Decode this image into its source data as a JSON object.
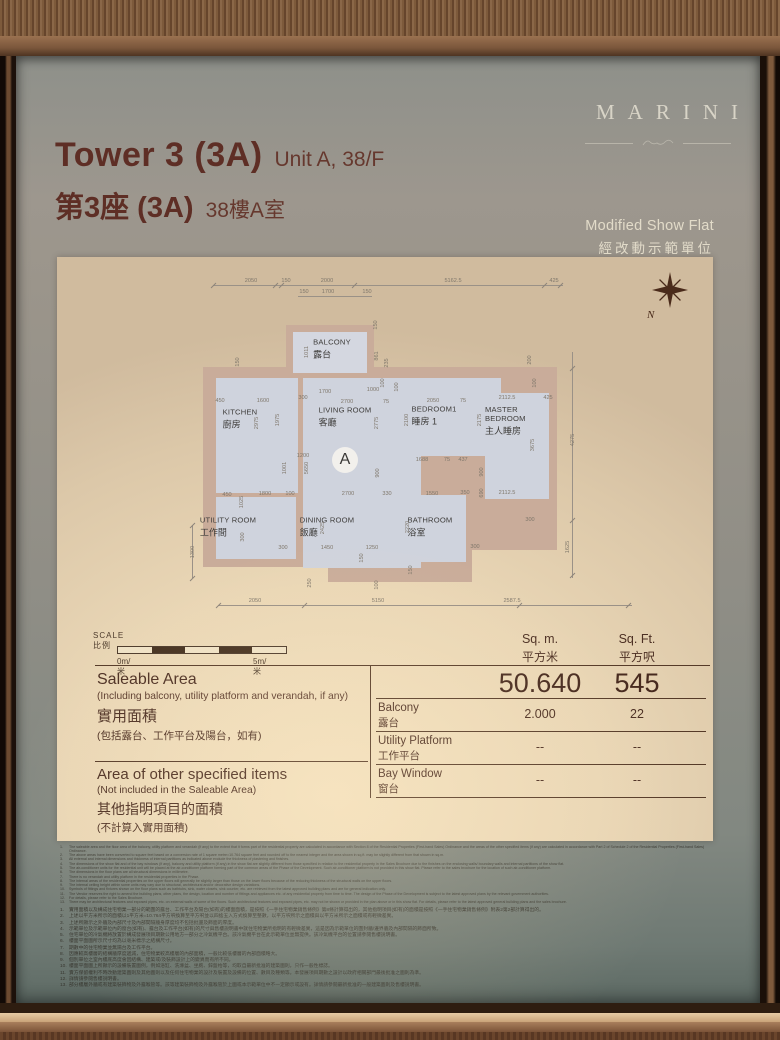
{
  "header": {
    "tower_en": "Tower 3 (3A)",
    "unit_en": "Unit A, 38/F",
    "tower_zh": "第3座 (3A)",
    "unit_zh": "38樓A室",
    "brand": "MARINI",
    "showflat_en": "Modified Show Flat",
    "showflat_zh": "經改動示範單位"
  },
  "floorplan": {
    "unit_marker": "A",
    "north_label": "N",
    "rooms": [
      {
        "en": "BALCONY",
        "zh": "露台",
        "x": 237,
        "y": 84
      },
      {
        "en": "KITCHEN",
        "zh": "廚房",
        "x": 145,
        "y": 154
      },
      {
        "en": "LIVING ROOM",
        "zh": "客廳",
        "x": 250,
        "y": 152
      },
      {
        "en": "BEDROOM1",
        "zh": "睡房 1",
        "x": 339,
        "y": 151
      },
      {
        "en": "MASTER BEDROOM",
        "zh": "主人睡房",
        "x": 418,
        "y": 156,
        "w": 56
      },
      {
        "en": "UTILITY ROOM",
        "zh": "工作間",
        "x": 133,
        "y": 262
      },
      {
        "en": "DINING ROOM",
        "zh": "飯廳",
        "x": 232,
        "y": 262
      },
      {
        "en": "BATHROOM",
        "zh": "浴室",
        "x": 335,
        "y": 262
      }
    ],
    "dims": [
      [
        "2050",
        156,
        16,
        0
      ],
      [
        "150",
        191,
        16,
        0
      ],
      [
        "2000",
        232,
        16,
        0
      ],
      [
        "5162.5",
        358,
        16,
        0
      ],
      [
        "425",
        459,
        16,
        0
      ],
      [
        "150",
        209,
        27,
        0
      ],
      [
        "1700",
        233,
        27,
        0
      ],
      [
        "150",
        272,
        27,
        0
      ],
      [
        "150",
        143,
        97,
        1
      ],
      [
        "1011",
        212,
        87,
        1
      ],
      [
        "150",
        281,
        60,
        1
      ],
      [
        "861",
        282,
        91,
        1
      ],
      [
        "235",
        292,
        98,
        1
      ],
      [
        "100",
        288,
        118,
        1
      ],
      [
        "450",
        125,
        136,
        0
      ],
      [
        "1600",
        168,
        136,
        0
      ],
      [
        "300",
        208,
        133,
        0
      ],
      [
        "2700",
        252,
        137,
        0
      ],
      [
        "75",
        291,
        137,
        0
      ],
      [
        "2050",
        338,
        136,
        0
      ],
      [
        "75",
        368,
        136,
        0
      ],
      [
        "2112.5",
        412,
        133,
        0
      ],
      [
        "425",
        453,
        133,
        0
      ],
      [
        "1700",
        230,
        127,
        0
      ],
      [
        "1000",
        278,
        125,
        0
      ],
      [
        "100",
        302,
        122,
        1
      ],
      [
        "2975",
        162,
        158,
        1
      ],
      [
        "1975",
        183,
        155,
        1
      ],
      [
        "2775",
        282,
        158,
        1
      ],
      [
        "2100",
        312,
        155,
        1
      ],
      [
        "2175",
        385,
        155,
        1
      ],
      [
        "3675",
        438,
        180,
        1
      ],
      [
        "200",
        435,
        95,
        1
      ],
      [
        "100",
        440,
        118,
        1
      ],
      [
        "5650",
        212,
        203,
        1
      ],
      [
        "1001",
        190,
        203,
        1
      ],
      [
        "1200",
        208,
        191,
        0
      ],
      [
        "900",
        283,
        208,
        1
      ],
      [
        "900",
        387,
        207,
        1
      ],
      [
        "690",
        387,
        228,
        1
      ],
      [
        "1688",
        327,
        195,
        0
      ],
      [
        "75",
        352,
        195,
        0
      ],
      [
        "437",
        368,
        195,
        0
      ],
      [
        "2112.5",
        412,
        228,
        0
      ],
      [
        "450",
        132,
        230,
        0
      ],
      [
        "1800",
        170,
        229,
        0
      ],
      [
        "100",
        195,
        229,
        0
      ],
      [
        "2700",
        253,
        229,
        0
      ],
      [
        "330",
        292,
        229,
        0
      ],
      [
        "1550",
        337,
        229,
        0
      ],
      [
        "350",
        370,
        228,
        0
      ],
      [
        "1025",
        147,
        237,
        1
      ],
      [
        "300",
        148,
        272,
        1
      ],
      [
        "2425",
        228,
        263,
        1
      ],
      [
        "2220",
        313,
        262,
        1
      ],
      [
        "1300",
        98,
        287,
        1
      ],
      [
        "150",
        267,
        293,
        1
      ],
      [
        "250",
        215,
        318,
        1
      ],
      [
        "100",
        282,
        320,
        1
      ],
      [
        "150",
        316,
        305,
        1
      ],
      [
        "300",
        188,
        283,
        0
      ],
      [
        "1450",
        232,
        283,
        0
      ],
      [
        "1250",
        277,
        283,
        0
      ],
      [
        "300",
        380,
        282,
        0
      ],
      [
        "300",
        435,
        255,
        0
      ],
      [
        "1625",
        473,
        282,
        1
      ],
      [
        "4275",
        478,
        175,
        1
      ],
      [
        "2050",
        160,
        336,
        0
      ],
      [
        "5150",
        283,
        336,
        0
      ],
      [
        "2587.5",
        417,
        336,
        0
      ]
    ]
  },
  "scale": {
    "en": "SCALE",
    "zh": "比例",
    "start": "0m/米",
    "end": "5m/米"
  },
  "table": {
    "headers": {
      "sqm_en": "Sq. m.",
      "sqm_zh": "平方米",
      "sqft_en": "Sq. Ft.",
      "sqft_zh": "平方呎"
    },
    "saleable": {
      "en": "Saleable Area",
      "en_sub": "(Including balcony, utility platform and verandah, if any)",
      "zh": "實用面積",
      "zh_sub": "(包括露台、工作平台及陽台，如有)",
      "sqm": "50.640",
      "sqft": "545"
    },
    "sub_rows": [
      {
        "en": "Balcony",
        "zh": "露台",
        "sqm": "2.000",
        "sqft": "22"
      },
      {
        "en": "Utility Platform",
        "zh": "工作平台",
        "sqm": "--",
        "sqft": "--"
      },
      {
        "en": "Bay Window",
        "zh": "窗台",
        "sqm": "--",
        "sqft": "--"
      }
    ],
    "other": {
      "en": "Area of other specified items",
      "en_sub": "(Not included in the Saleable Area)",
      "zh": "其他指明項目的面積",
      "zh_sub": "(不計算入實用面積)"
    }
  },
  "notes_en": [
    "The saleable area and the floor area of the balcony, utility platform and verandah (if any) to the extent that it forms part of the residential property are calculated in accordance with Section 8 of the Residential Properties (First-hand Sales) Ordinance and the areas of the other specified items (if any) are calculated in accordance with Part 2 of Schedule 2 of the Residential Properties (First-hand Sales) Ordinance.",
    "The above areas have been converted to square feet based on a conversion rate of 1 square metre=10.764 square feet and rounded off to the nearest integer and the area shown in sq.ft. may be slightly different from that shown in sq.m.",
    "All external and internal dimensions and thickness of internal partitions as indicated above exclude the thickness of plastering and finishes.",
    "The dimensions of the show flat and of the bay windows (if any), balcony and utility platform (if any) in the show flat are slightly different from those specified in relation to the residential property in the Sales Brochure due to the finishes on the enclosing walls/ boundary walls and internal partitions of the show flat.",
    "The air-conditioner units for the residential unit will be placed at the air-conditioner platform forming part of the common areas of the Phase of the Development. Such air-conditioner platform is not provided in this show flat. Please refer to the sales brochure for the location of such air-conditioner platform.",
    "The dimensions in the floor plans are all structural dimensions in millimetre.",
    "There is no verandah and utility platform in the residential properties in the Phase.",
    "The internal areas of the residential properties on the upper floors will generally be slightly larger than those on the lower floors because of the reducing thickness of the structural walls on the upper floors.",
    "The internal ceiling height within some units may vary due to structural, architectural and/or decorative design variations.",
    "Symbols of fittings and fixtures shown on the floor plans such as bathtubs, sink, water closets, sink counter, etc. are retrieved from the latest approved building plans and are for general indication only.",
    "The Vendor reserves the right to amend the building plans, other plans, the design, location and number of fittings and appliances etc. of any residential property from time to time. The design of the Phase of the Development is subject to the latest approved plans by the relevant government authorities.",
    "For details, please refer to the Sales Brochure.",
    "There may be architectural features and exposed pipes, etc. on external walls of some of the floors. Such architectural features and exposed pipes, etc. may not be shown or provided in the plan above or in this show flat. For details, please refer to the latest approved general building plans and the sales brochure."
  ],
  "notes_zh": [
    "實用面積以及構成住宅物業一部分的範圍的露台、工作平台及陽台(如有)的樓面面積，是按照《一手住宅物業銷售條例》第8條計算得出的，其他指明項目(如有)的面積是按照《一手住宅物業銷售條例》附表2第2部計算得出的。",
    "上述以平方米所示的面積以1平方米=10.764平方呎換算至平方呎並以四捨五入方式換算至整數，以平方呎所示之面積與以平方米所示之面積或有輕微差異。",
    "上述所顯示之外牆及內部尺寸及內部間隔牆身厚度均不包括批盪及飾面的厚度。",
    "示範單位及示範單位內的窗台(如有)、露台及工作平台(如有)的尺寸與售樓說明書中就住宅物業所指明的有輕微差異，這是因為示範單位的圍封牆/邊界牆及內部間隔的飾面所致。",
    "住宅單位的冷氣機將放置於構成發展項目期數公用地方一部分之冷氣機平台。該冷氣機平台在此示範單位並無提供。該冷氣機平台的位置請參閱售樓說明書。",
    "樓面平面圖所示尺寸均為以毫米標示之結構尺寸。",
    "期數中的住宅物業並無陽台及工作平台。",
    "因應較高樓層的結構牆厚度遞減，住宅物業較高樓層的內部面積，一般比較低樓層的內部面積略大。",
    "個別單位之室內樓底高度會因結構、建築或/及裝飾設計上的變異而有所不同。",
    "樓面平面圖上所顯示的設備裝置圖例，例如浴缸、洗滌盆、坐廁、鋅盤枱等，均取自最新批准的建築圖則，只作一般性標誌。",
    "賣方保留權利不時改動建築圖則及其他圖則以及任何住宅物業的設計及裝置及設備的位置、數目及種類等。本發展項目期數之設計以政府相關部門最後批准之圖則為準。",
    "詳情請參閱售樓說明書。",
    "部分樓層外牆或有建築裝飾物及外露喉管等。該等建築裝飾物及外露喉管於上圖或本示範單位中不一定顯示或設有。詳情請參閱最新批准的一般建築圖則及售樓說明書。"
  ]
}
